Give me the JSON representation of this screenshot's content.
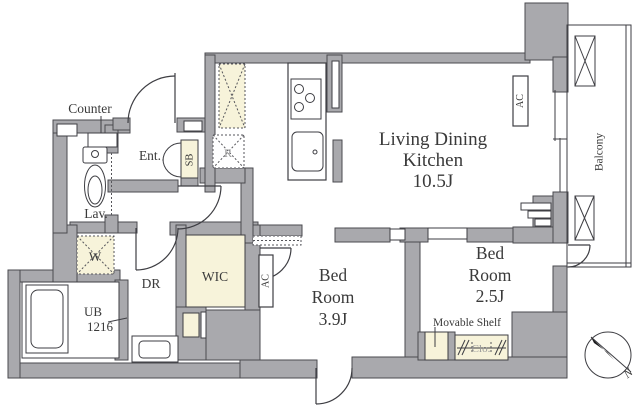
{
  "plan": {
    "type": "apartment-floor-plan",
    "north_label": "N"
  },
  "rooms": {
    "ldk": {
      "name_lines": [
        "Living Dining",
        "Kitchen",
        "10.5J"
      ],
      "size_tatami": "10.5J"
    },
    "bedroom1": {
      "name_lines": [
        "Bed",
        "Room",
        "3.9J"
      ],
      "size_tatami": "3.9J"
    },
    "bedroom2": {
      "name_lines": [
        "Bed",
        "Room",
        "2.5J"
      ],
      "size_tatami": "2.5J"
    },
    "entrance": {
      "label": "Ent."
    },
    "lavatory": {
      "label": "Lav."
    },
    "dressing_room": {
      "label": "DR"
    },
    "walk_in_closet": {
      "label": "WIC"
    },
    "unit_bath": {
      "label_lines": [
        "UB",
        "1216"
      ],
      "size": "1216"
    },
    "balcony": {
      "label": "Balcony"
    }
  },
  "fixtures": {
    "counter": {
      "label": "Counter"
    },
    "shoe_box": {
      "label": "SB"
    },
    "refrigerator_space": {
      "label": "R"
    },
    "washer_space": {
      "label": "W"
    },
    "air_conditioner_ldk": {
      "label": "AC"
    },
    "air_conditioner_bedroom": {
      "label": "AC"
    },
    "movable_shelf": {
      "label": "Movable Shelf"
    },
    "closet": {
      "label": "Clo."
    }
  },
  "colors": {
    "wall_fill": "#a9a9ad",
    "outline": "#3e3e43",
    "accent_cream": "#f7f3da",
    "background": "#ffffff",
    "label_text": "#3a3a3a",
    "muted_text": "#9a9a9a"
  }
}
